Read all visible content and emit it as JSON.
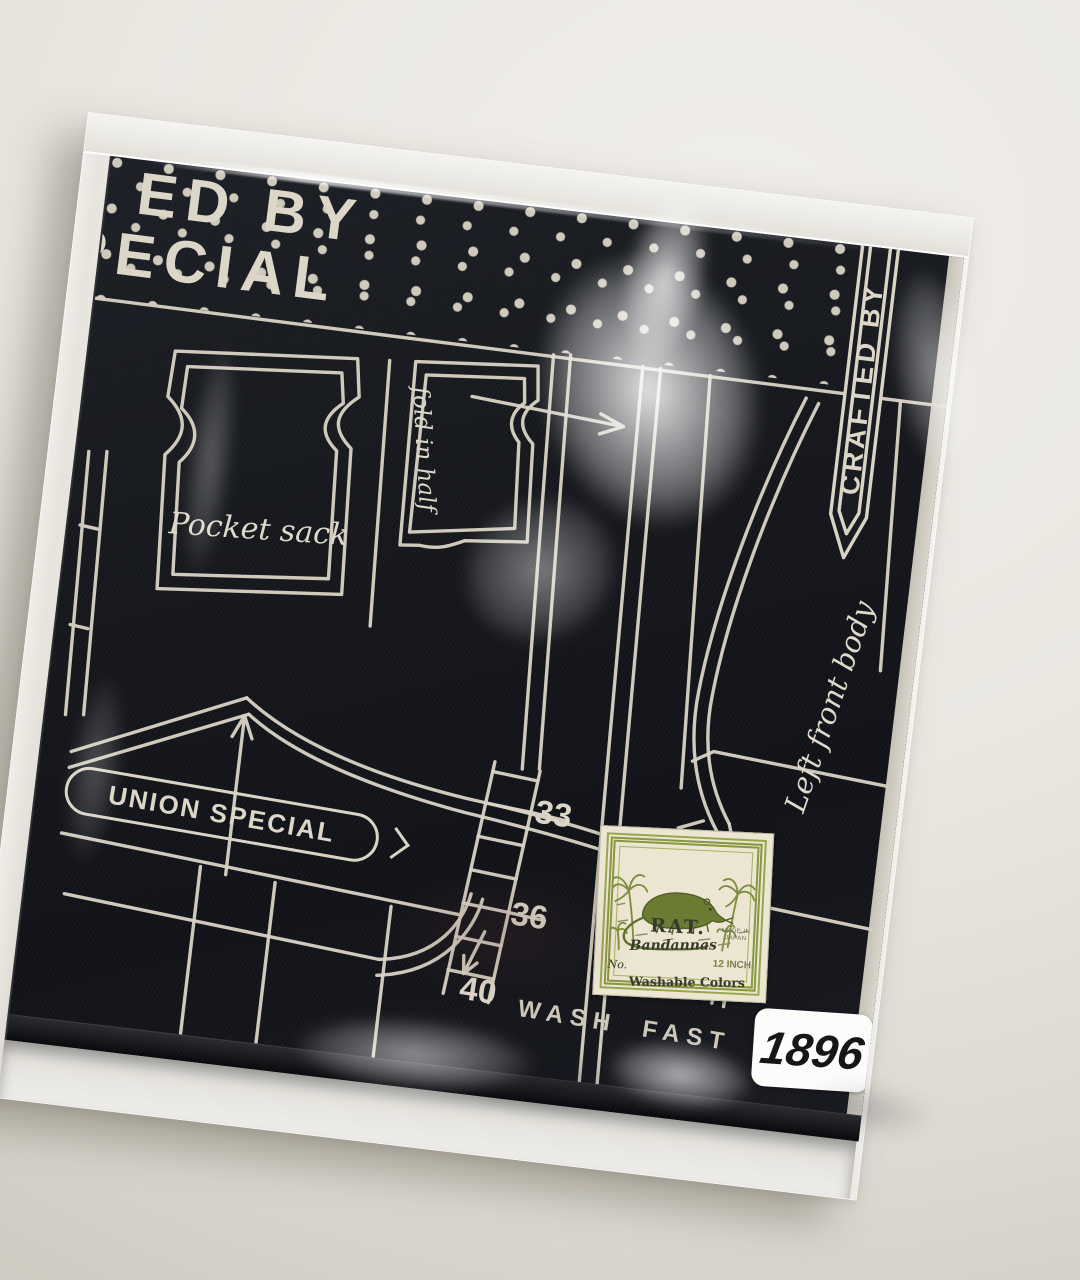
{
  "scene": {
    "description": "Black bandana printed with a white sewing-pattern design, packed in a clear plastic sleeve lying on a light desk"
  },
  "bandana": {
    "top_line1": "ED BY",
    "top_line2": "PECIAL",
    "pocket_label": "Pocket sack",
    "fold_label": "fold in half",
    "union_banner": "UNION SPECIAL",
    "crafted_banner": "CRAFTED BY",
    "left_front_body_label": "Left front body",
    "size_marks": [
      "33",
      "36",
      "40"
    ],
    "wash_text": {
      "word1": "WASH",
      "word2": "FAST",
      "word3": "COLOR"
    }
  },
  "label": {
    "title": "RAT.",
    "subtitle": "Bandannas",
    "no_field": "No.",
    "made_in_line1": "MADE IN",
    "made_in_line2": "JAPAN",
    "size_text": "12 INCH.",
    "washable_text": "Washable Colors"
  },
  "price_sticker": {
    "number": "1896"
  },
  "colors": {
    "fabric": "#16181d",
    "print": "#d9d3c5",
    "label_green": "#87963f",
    "label_bg": "#ece5d1",
    "desk": "#e9e6e0"
  }
}
